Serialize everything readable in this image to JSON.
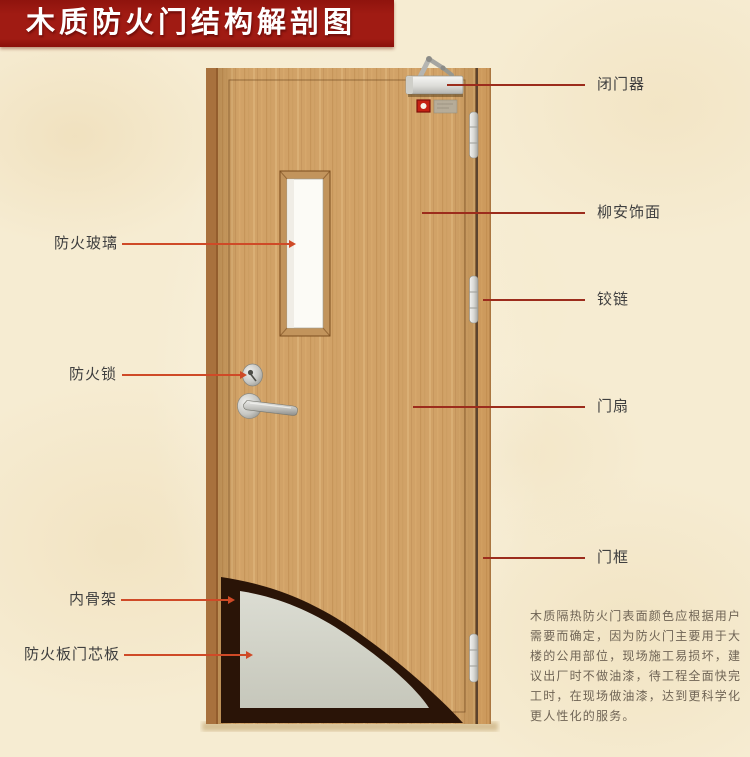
{
  "page": {
    "title": "木质防火门结构解剖图"
  },
  "callouts": {
    "left": [
      {
        "id": "fire-glass",
        "text": "防火玻璃"
      },
      {
        "id": "fire-lock",
        "text": "防火锁"
      },
      {
        "id": "inner-skeleton",
        "text": "内骨架"
      },
      {
        "id": "core-board",
        "text": "防火板门芯板"
      }
    ],
    "right": [
      {
        "id": "door-closer",
        "text": "闭门器"
      },
      {
        "id": "veneer",
        "text": "柳安饰面"
      },
      {
        "id": "hinge",
        "text": "铰链"
      },
      {
        "id": "door-leaf",
        "text": "门扇"
      },
      {
        "id": "door-frame",
        "text": "门框"
      }
    ]
  },
  "description": {
    "lines": [
      "木质隔热防火门表面颜色应根据用户",
      "需要而确定，因为防火门主要用于大",
      "楼的公用部位，现场施工易损坏，建",
      "议出厂时不做油漆，待工程全面快完",
      "工时，在现场做油漆，达到更科学化",
      "更人性化的服务。"
    ]
  },
  "colors": {
    "banner_red": "#a01b13",
    "callout_line_left": "#cf4a27",
    "callout_line_right": "#9c2c1c",
    "background_cream": "#f6ecd2",
    "wood_base": "#d1a267",
    "core_gray": "#d5d6cb",
    "skeleton_dark": "#2a1407"
  }
}
